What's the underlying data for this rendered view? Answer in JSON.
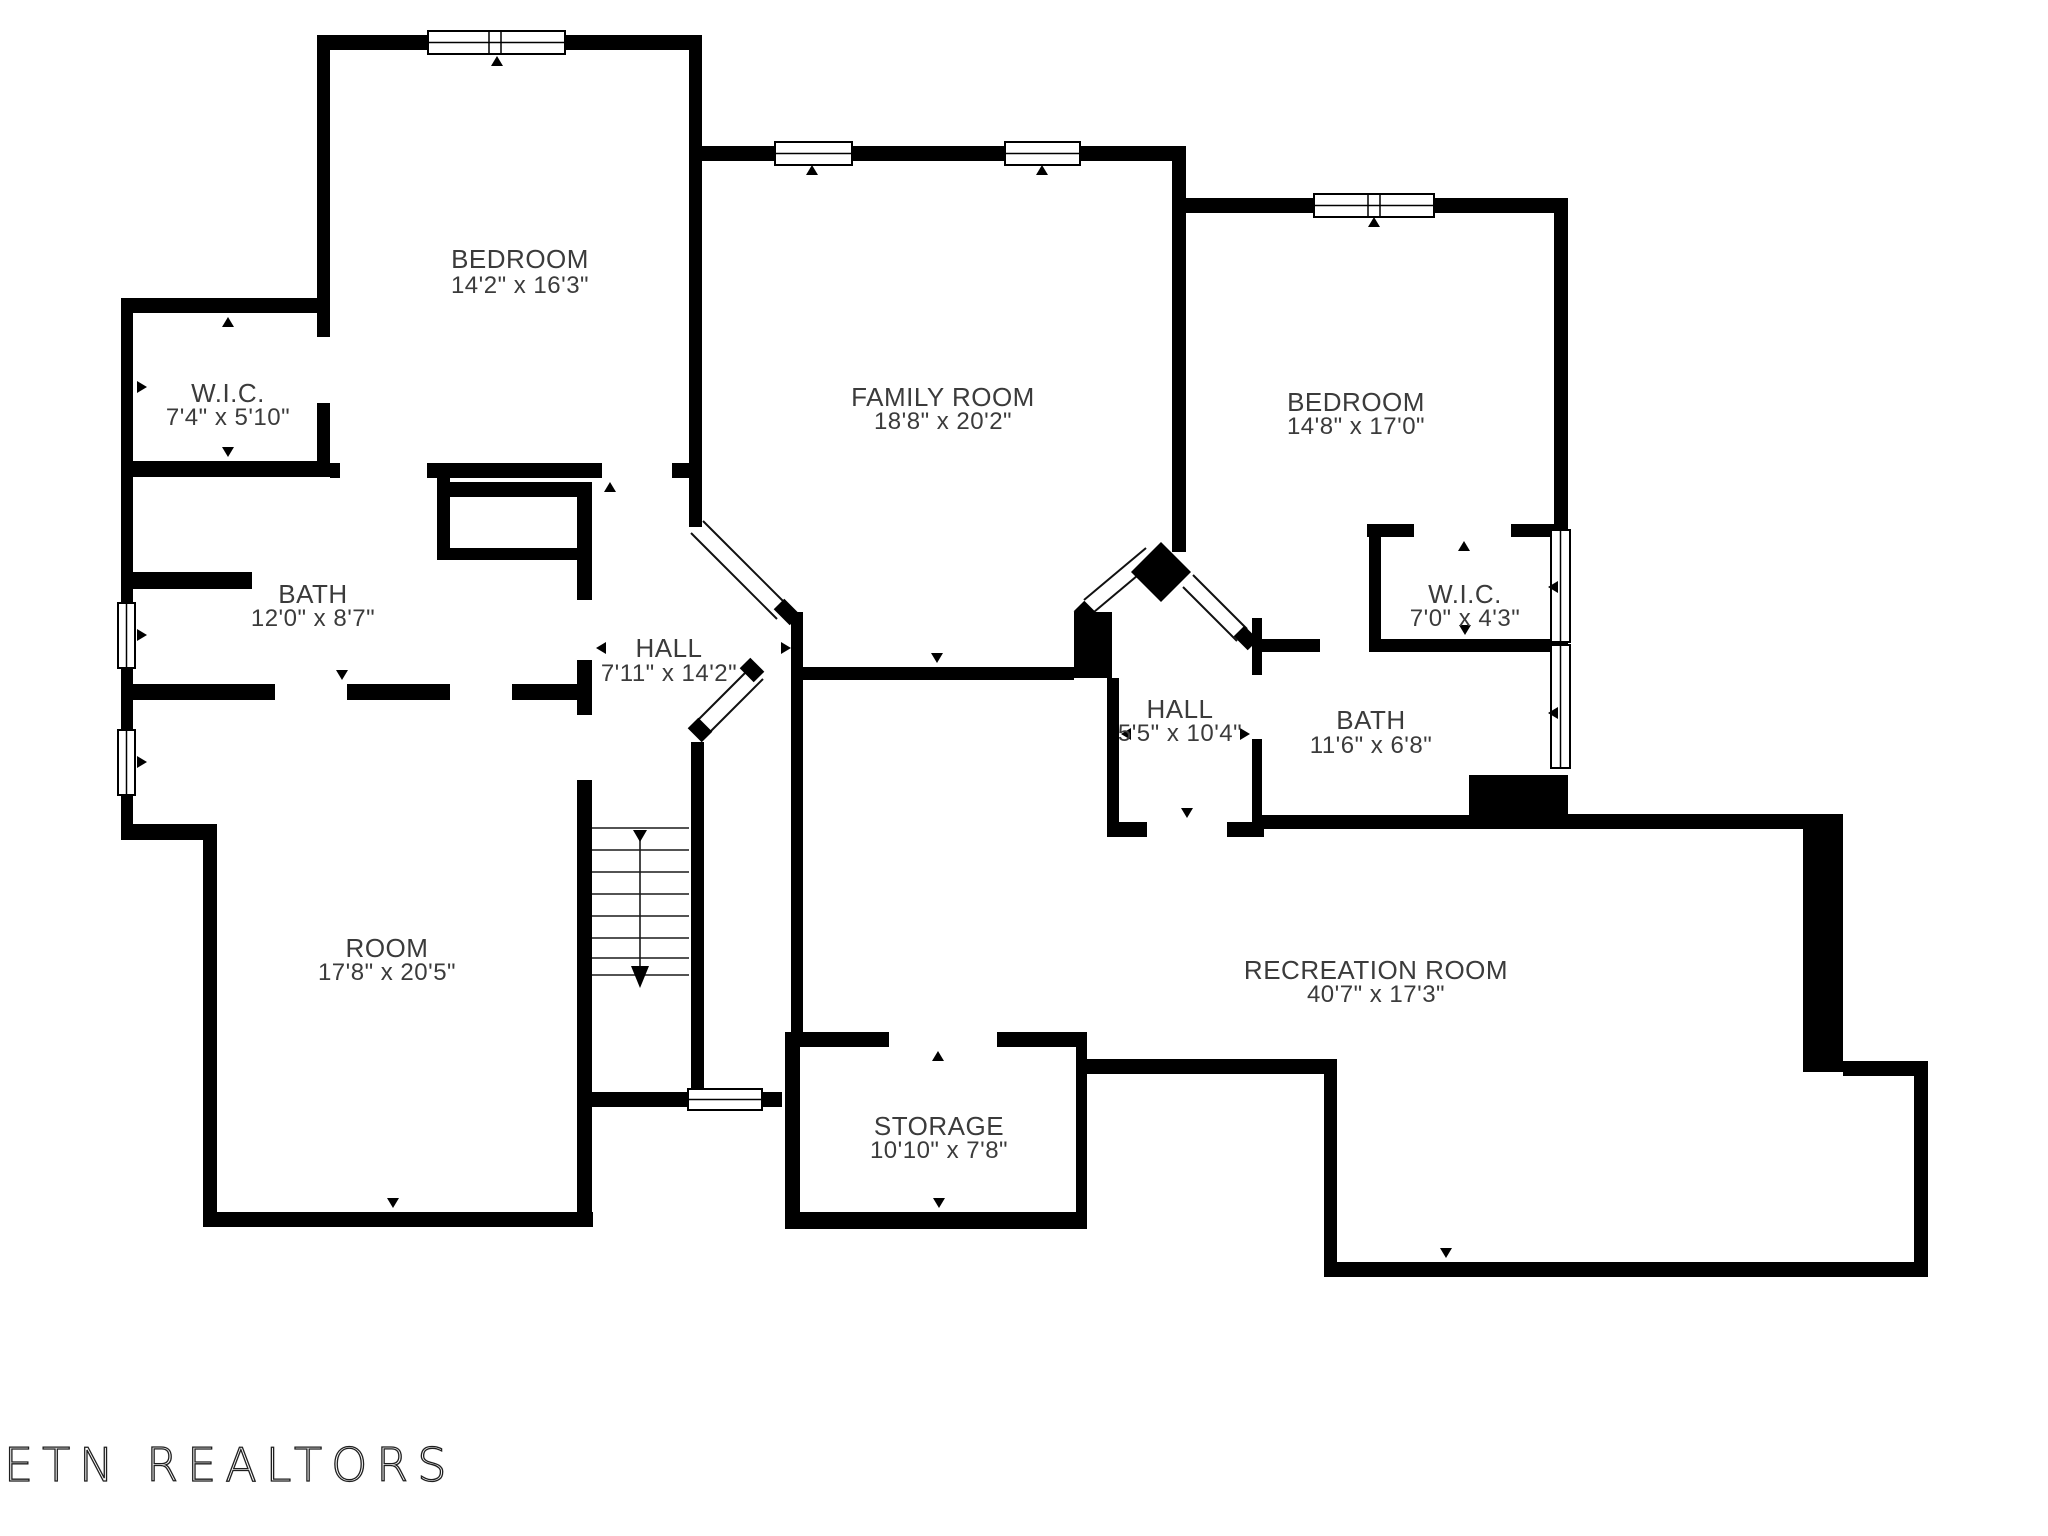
{
  "branding": {
    "logo_text": "ETN REALTORS"
  },
  "floor_plan": {
    "wall_color": "#000000",
    "label_color": "#3b3b3b",
    "rooms": [
      {
        "id": "bedroom-left",
        "name": "BEDROOM",
        "dimensions": "14'2\" x 16'3\""
      },
      {
        "id": "wic-left",
        "name": "W.I.C.",
        "dimensions": "7'4\" x 5'10\""
      },
      {
        "id": "bath-left",
        "name": "BATH",
        "dimensions": "12'0\" x 8'7\""
      },
      {
        "id": "family-room",
        "name": "FAMILY ROOM",
        "dimensions": "18'8\" x 20'2\""
      },
      {
        "id": "bedroom-right",
        "name": "BEDROOM",
        "dimensions": "14'8\" x 17'0\""
      },
      {
        "id": "wic-right",
        "name": "W.I.C.",
        "dimensions": "7'0\" x 4'3\""
      },
      {
        "id": "bath-right",
        "name": "BATH",
        "dimensions": "11'6\" x 6'8\""
      },
      {
        "id": "hall-left",
        "name": "HALL",
        "dimensions": "7'11\" x 14'2\""
      },
      {
        "id": "hall-right",
        "name": "HALL",
        "dimensions": "5'5\" x 10'4\""
      },
      {
        "id": "room",
        "name": "ROOM",
        "dimensions": "17'8\" x 20'5\""
      },
      {
        "id": "recreation-room",
        "name": "RECREATION ROOM",
        "dimensions": "40'7\" x 17'3\""
      },
      {
        "id": "storage",
        "name": "STORAGE",
        "dimensions": "10'10\" x 7'8\""
      }
    ]
  }
}
